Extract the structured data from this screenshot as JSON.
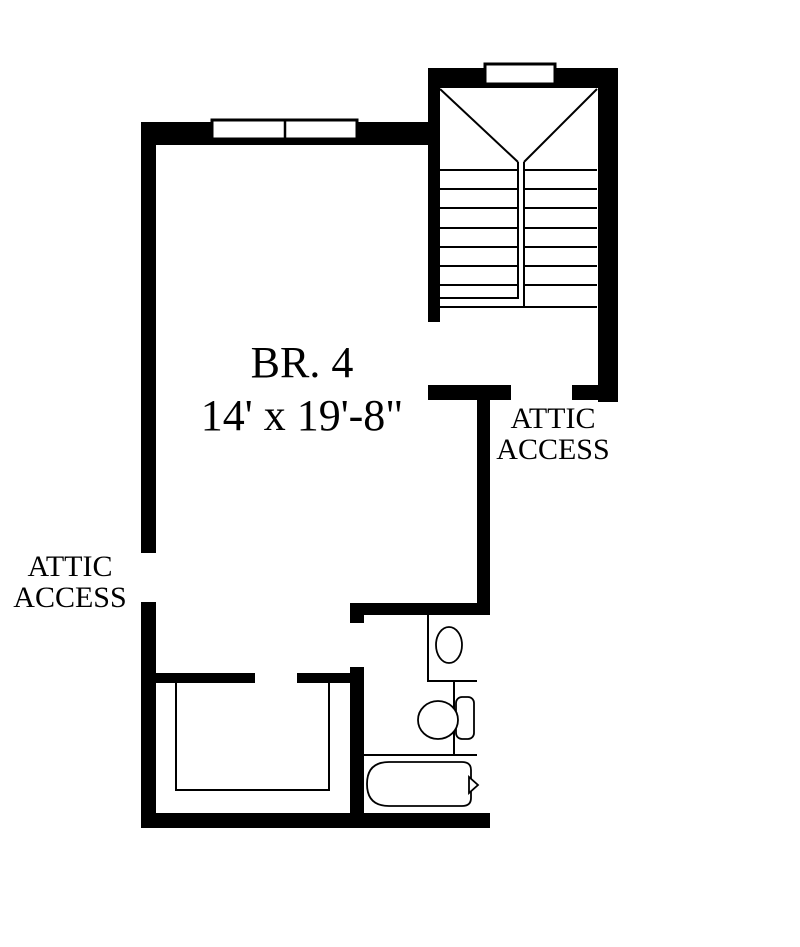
{
  "title": "Second floor plan detail",
  "colors": {
    "background": "#ffffff",
    "walls": "#000000",
    "thin_lines": "#000000"
  },
  "room": {
    "name": "BR. 4",
    "dimensions": "14' x 19'-8\""
  },
  "annotations": {
    "attic_access_right": "ATTIC ACCESS",
    "attic_access_left": "ATTIC ACCESS"
  },
  "features": {
    "staircase": "u-return staircase with center rail",
    "windows": [
      "double window on bedroom top wall",
      "single window on stair top wall"
    ],
    "closet": "closet with rod outline at bottom left",
    "bathroom_fixtures": [
      "sink-vanity",
      "toilet",
      "bathtub with spout marker"
    ]
  }
}
